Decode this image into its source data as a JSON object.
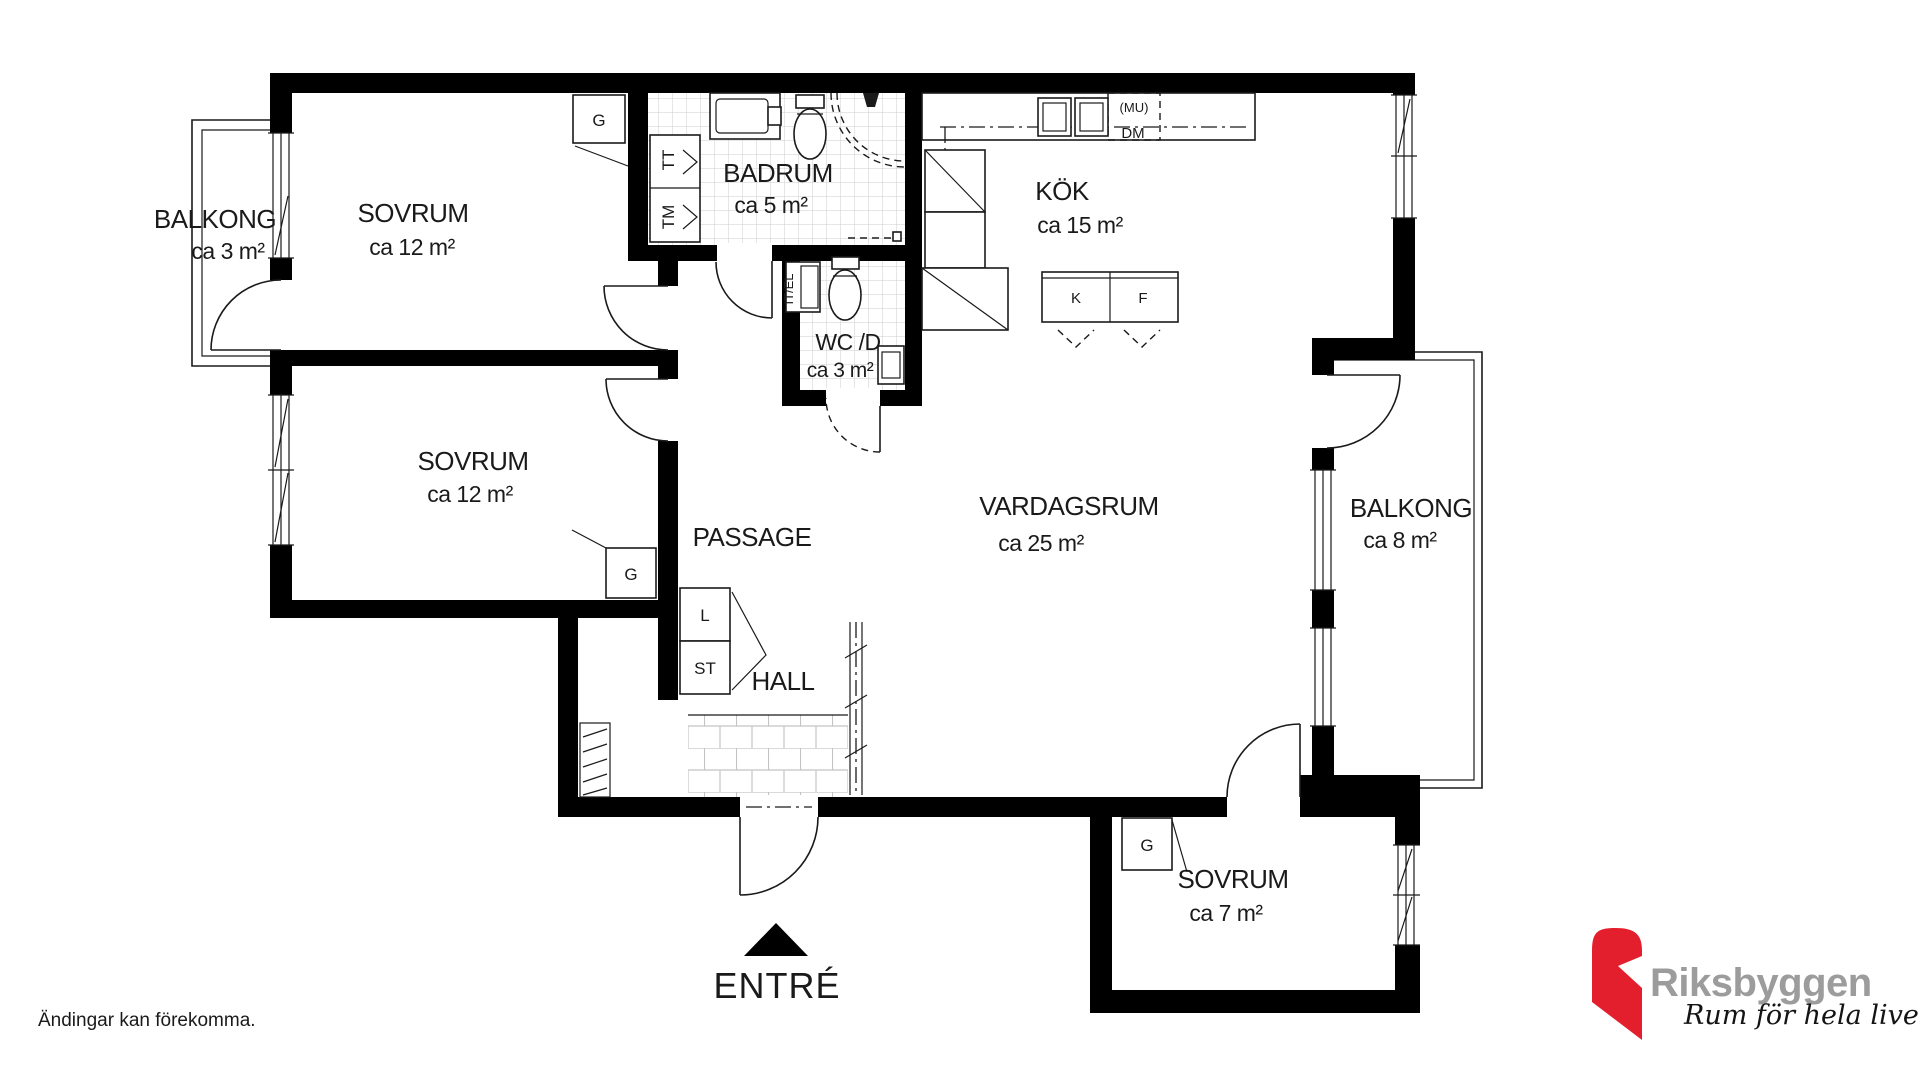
{
  "plan": {
    "rooms": {
      "balkong1": {
        "name": "BALKONG",
        "area": "ca 3 m²"
      },
      "sovrum1": {
        "name": "SOVRUM",
        "area": "ca 12 m²"
      },
      "badrum": {
        "name": "BADRUM",
        "area": "ca 5 m²"
      },
      "kok": {
        "name": "KÖK",
        "area": "ca 15 m²"
      },
      "sovrum2": {
        "name": "SOVRUM",
        "area": "ca 12 m²"
      },
      "wc": {
        "name": "WC /D",
        "area": "ca 3 m²"
      },
      "passage": {
        "name": "PASSAGE"
      },
      "vardagsrum": {
        "name": "VARDAGSRUM",
        "area": "ca 25 m²"
      },
      "balkong2": {
        "name": "BALKONG",
        "area": "ca 8 m²"
      },
      "hall": {
        "name": "HALL"
      },
      "sovrum3": {
        "name": "SOVRUM",
        "area": "ca 7 m²"
      }
    },
    "fixtures": {
      "g1": "G",
      "g2": "G",
      "g3": "G",
      "tt": "TT",
      "tm": "TM",
      "l": "L",
      "st": "ST",
      "itel": "IT/EL",
      "k": "K",
      "f": "F",
      "mu": "(MU)",
      "dm": "DM"
    },
    "entry_label": "ENTRÉ"
  },
  "footer": {
    "disclaimer": "Ändingar kan förekomma."
  },
  "logo": {
    "brand": "Riksbyggen",
    "tagline": "Rum för hela livet",
    "brand_color": "#9c9c9c",
    "mark_color": "#e41f2d"
  }
}
